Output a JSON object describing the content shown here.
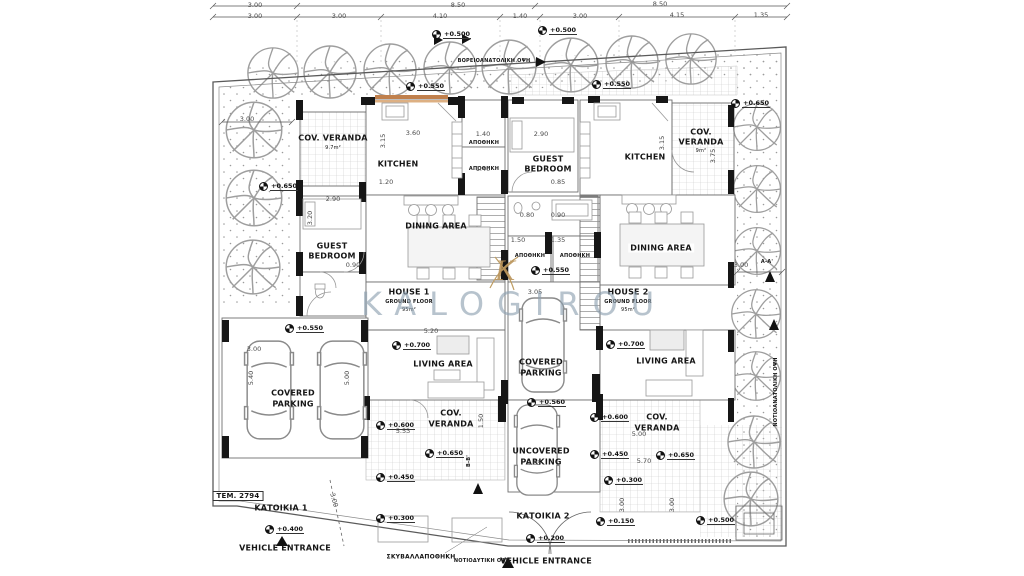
{
  "watermark": {
    "brand": "KALOGIROU",
    "monogram": "K"
  },
  "top_dims": {
    "row1": [
      "3.00",
      "8.50",
      "8.50"
    ],
    "row2": [
      "3.00",
      "3.00",
      "4.10",
      "1.40",
      "3.00",
      "4.15",
      "1.35"
    ]
  },
  "rooms": {
    "cov_veranda": "COV. VERANDA",
    "cov_veranda_area": "9.7m²",
    "kitchen": "KITCHEN",
    "storage": "ΑΠΟΘΗΚΗ",
    "guest_line1": "GUEST",
    "guest_line2": "BEDROOM",
    "dining": "DINING AREA",
    "living": "LIVING AREA",
    "covered_line1": "COVERED",
    "parking_line2": "PARKING",
    "uncovered_line1": "UNCOVERED",
    "cov_line1": "COV.",
    "veranda_line2": "VERANDA",
    "cov_veranda_area_sm": "9m²"
  },
  "houses": {
    "h1": {
      "name": "HOUSE 1",
      "floor": "GROUND FLOOR",
      "area": "95m²"
    },
    "h2": {
      "name": "HOUSE 2",
      "floor": "GROUND FLOOR",
      "area": "95m²"
    }
  },
  "site": {
    "plot_no": "ΤΕΜ. 2794",
    "katoikia1": "ΚΑΤΟΙΚΙΑ 1",
    "katoikia2": "ΚΑΤΟΙΚΙΑ 2",
    "vehicle_entrance": "VEHICLE ENTRANCE",
    "garbage_store": "ΣΚΥΒΑΛΛΑΠΟΘΗΚΗ",
    "elev_sw": "ΝΟΤΙΟΔΥΤΙΚΗ ΟΨΗ",
    "elev_ne": "ΒΟΡΕΙΟΑΝΑΤΟΛΙΚΗ ΟΨΗ",
    "elev_se": "ΝΟΤΙΟΑΝΑΤΟΛΙΚΗ ΟΨΗ",
    "section_aa": "Α-Α'",
    "section_bb": "Β-Β'"
  },
  "elevations": [
    "+0.500",
    "+0.500",
    "+0.550",
    "+0.550",
    "+0.650",
    "+0.650",
    "+0.550",
    "+0.550",
    "+0.700",
    "+0.700",
    "+0.560",
    "+0.600",
    "+0.650",
    "+0.450",
    "+0.600",
    "+0.450",
    "+0.650",
    "+0.300",
    "+0.400",
    "+0.200",
    "+0.150",
    "+0.300",
    "+0.500"
  ],
  "dims": [
    "3.60",
    "3.15",
    "1.20",
    "2.90",
    "3.20",
    "0.90",
    "2.90",
    "3.15",
    "0.85",
    "3.05",
    "1.50",
    "1.35",
    "0.80",
    "0.90",
    "3.00",
    "5.40",
    "5.00",
    "5.20",
    "5.53",
    "1.50",
    "5.00",
    "5.70",
    "3.05",
    "3.00",
    "3.00",
    "3.00",
    "3.00",
    "3.00",
    "1.40",
    "1.40",
    "3.75"
  ]
}
